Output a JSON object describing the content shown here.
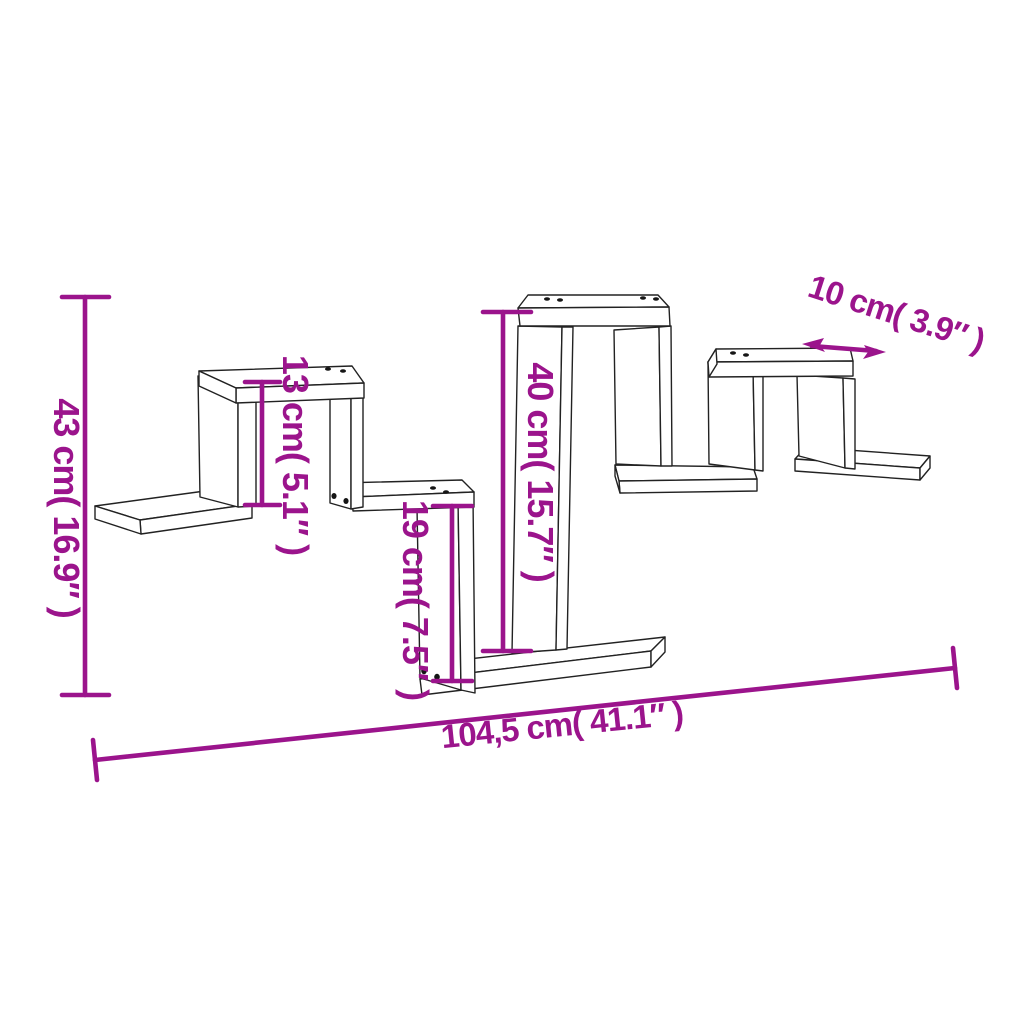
{
  "diagram": {
    "background": "#ffffff",
    "accent_color": "#9B148C",
    "line_color": "#222222",
    "subject": "zigzag-wall-shelf-line-drawing",
    "dimensions": {
      "overall_height": "43 cm( 16.9″ )",
      "cube_height": "13 cm( 5.1″ )",
      "tall_box_height": "40 cm( 15.7″ )",
      "lower_box_height": "19 cm( 7.5″ )",
      "depth": "10 cm( 3.9″ )",
      "overall_width": "104,5 cm( 41.1″ )"
    }
  }
}
